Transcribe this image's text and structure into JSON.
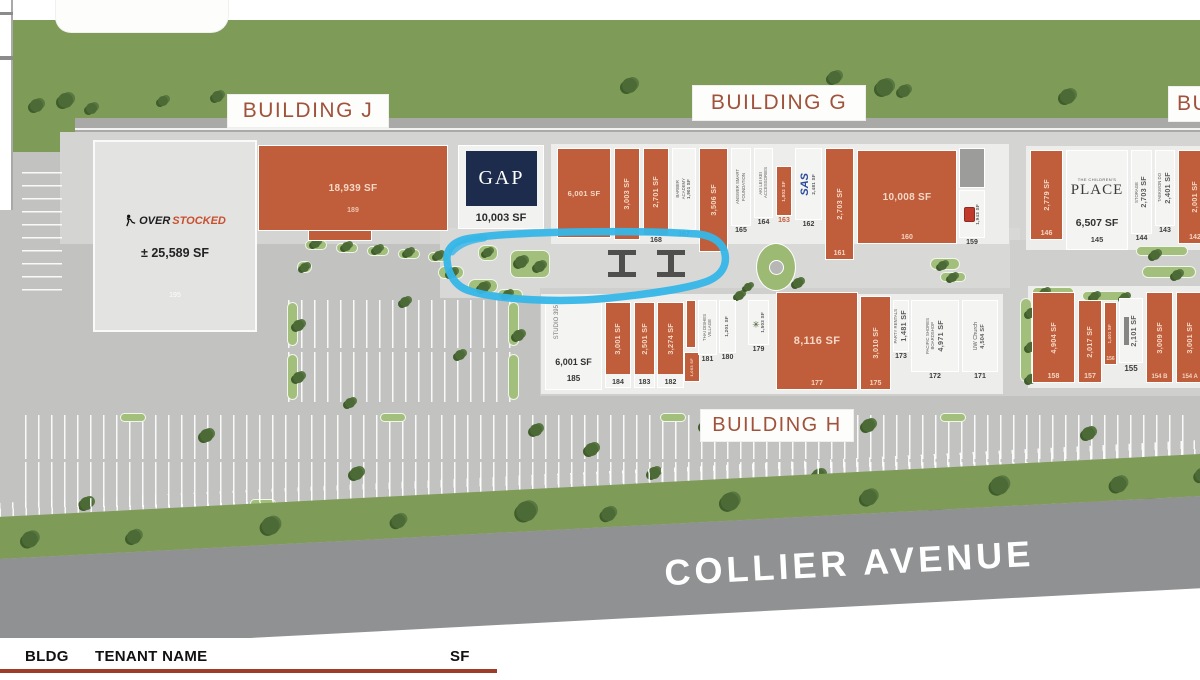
{
  "page": {
    "bg": "#ffffff"
  },
  "labels": {
    "building_j": "BUILDING J",
    "building_g": "BUILDING G",
    "building_f": "BUILDING F",
    "building_h": "BUILDING H"
  },
  "street": {
    "name": "COLLIER AVENUE"
  },
  "table_header": {
    "bldg": "BLDG",
    "tenant": "TENANT NAME",
    "sf": "SF"
  },
  "highlight": {
    "color": "#35b6e8"
  },
  "anchors": {
    "overstocked": {
      "prefix": "OVER",
      "suffix": "STOCKED",
      "sf": "± 25,589 SF",
      "num": "195"
    },
    "gap": {
      "logo": "GAP",
      "sf": "10,003 SF"
    },
    "childrens_place": {
      "top": "THE CHILDREN'S",
      "main": "PLACE"
    }
  },
  "units": [
    {
      "id": "189",
      "num": "189",
      "sf": "18,939 SF",
      "x": 258,
      "y": 145,
      "w": 190,
      "h": 86,
      "fill": "orange",
      "txt": "h",
      "numPos": "on",
      "sfFs": 10,
      "numBottom": 16,
      "numColor": "#eec4ad"
    },
    {
      "id": "170",
      "sf": "6,001 SF",
      "x": 557,
      "y": 148,
      "w": 54,
      "h": 90,
      "fill": "orange",
      "txt": "h",
      "sfFs": 7.5
    },
    {
      "id": "169",
      "sf": "3,003 SF",
      "x": 614,
      "y": 148,
      "w": 26,
      "h": 92,
      "fill": "orange",
      "txt": "v"
    },
    {
      "id": "168",
      "num": "168",
      "sf": "2,701 SF",
      "x": 643,
      "y": 148,
      "w": 26,
      "h": 88,
      "fill": "orange",
      "txt": "v",
      "numPos": "below"
    },
    {
      "id": "167",
      "num": "167",
      "name": "BARBER\nACADEMY",
      "sf": "1,901 SF",
      "x": 672,
      "y": 148,
      "w": 24,
      "h": 82,
      "fill": "white",
      "txt": "v",
      "numPos": "below",
      "sfFs": 4.3
    },
    {
      "id": "166",
      "sf": "3,506 SF",
      "x": 699,
      "y": 148,
      "w": 29,
      "h": 104,
      "fill": "orange",
      "txt": "v"
    },
    {
      "id": "165",
      "num": "165",
      "name": "ANSWER SMART\nFOUNDATION",
      "x": 731,
      "y": 148,
      "w": 20,
      "h": 78,
      "fill": "white",
      "txt": "v",
      "numPos": "below"
    },
    {
      "id": "164",
      "num": "164",
      "name": "AKI LEI KEI\nACCESSORIES",
      "x": 754,
      "y": 148,
      "w": 19,
      "h": 70,
      "fill": "white",
      "txt": "v",
      "numPos": "below"
    },
    {
      "id": "163",
      "num": "163",
      "sf": "1,802 SF",
      "x": 776,
      "y": 166,
      "w": 16,
      "h": 50,
      "fill": "orange",
      "txt": "v",
      "numPos": "below",
      "numColor": "#c05e3b",
      "sfFs": 4.5
    },
    {
      "id": "162",
      "num": "162",
      "name": "SAS",
      "sf": "2,481 SF",
      "x": 795,
      "y": 148,
      "w": 27,
      "h": 72,
      "fill": "white",
      "txt": "v",
      "logo": "sas",
      "numPos": "below",
      "sfFs": 4.5
    },
    {
      "id": "161",
      "num": "161",
      "sf": "2,703 SF",
      "x": 825,
      "y": 148,
      "w": 29,
      "h": 112,
      "fill": "orange",
      "txt": "v",
      "numPos": "on"
    },
    {
      "id": "160",
      "num": "160",
      "sf": "10,008 SF",
      "x": 857,
      "y": 150,
      "w": 100,
      "h": 94,
      "fill": "orange",
      "txt": "h",
      "numPos": "on",
      "sfFs": 10
    },
    {
      "id": "svc-g",
      "x": 959,
      "y": 148,
      "w": 26,
      "h": 40,
      "fill": "dark"
    },
    {
      "id": "159",
      "num": "159",
      "sf": "1,943 SF",
      "x": 959,
      "y": 190,
      "w": 26,
      "h": 48,
      "fill": "white",
      "txt": "v",
      "icon": "red",
      "numPos": "below",
      "sfFs": 4.5
    },
    {
      "id": "146",
      "num": "146",
      "sf": "2,779 SF",
      "x": 1030,
      "y": 150,
      "w": 33,
      "h": 90,
      "fill": "orange",
      "txt": "v",
      "numPos": "on"
    },
    {
      "id": "145",
      "num": "145",
      "sf": "6,507 SF",
      "x": 1066,
      "y": 150,
      "w": 62,
      "h": 100,
      "fill": "white",
      "logo": "childrens"
    },
    {
      "id": "144",
      "num": "144",
      "name": "STORAGE",
      "sf": "2,703 SF",
      "x": 1131,
      "y": 150,
      "w": 21,
      "h": 84,
      "fill": "white",
      "txt": "v",
      "numPos": "below"
    },
    {
      "id": "143",
      "num": "143",
      "name": "TAEKWON DO",
      "sf": "2,401 SF",
      "x": 1155,
      "y": 150,
      "w": 20,
      "h": 76,
      "fill": "white",
      "txt": "v",
      "numPos": "below"
    },
    {
      "id": "142",
      "num": "142",
      "sf": "2,001 SF",
      "x": 1178,
      "y": 150,
      "w": 34,
      "h": 94,
      "fill": "orange",
      "txt": "v",
      "numPos": "on"
    },
    {
      "id": "185",
      "num": "185",
      "name": "STUDIO 395",
      "sf": "6,001 SF",
      "x": 545,
      "y": 298,
      "w": 57,
      "h": 92,
      "fill": "white",
      "logo": "studio"
    },
    {
      "id": "184",
      "num": "184",
      "sf": "3,001 SF",
      "x": 605,
      "y": 302,
      "w": 26,
      "h": 86,
      "fill": "orange-strip",
      "txt": "v",
      "numPos": "strip"
    },
    {
      "id": "183",
      "num": "183",
      "sf": "2,501 SF",
      "x": 634,
      "y": 302,
      "w": 21,
      "h": 86,
      "fill": "orange-strip",
      "txt": "v",
      "numPos": "strip"
    },
    {
      "id": "182",
      "num": "182",
      "sf": "3,274 SF",
      "x": 657,
      "y": 302,
      "w": 27,
      "h": 86,
      "fill": "orange-strip",
      "txt": "v",
      "numPos": "strip"
    },
    {
      "id": "sliver-a",
      "x": 686,
      "y": 300,
      "w": 10,
      "h": 48,
      "fill": "orange"
    },
    {
      "id": "sliver-b",
      "sf": "1,003 SF",
      "x": 684,
      "y": 352,
      "w": 16,
      "h": 30,
      "fill": "orange",
      "txt": "v",
      "sfFs": 4
    },
    {
      "id": "181",
      "num": "181",
      "name": "THAI DISHES\nVILLAGE",
      "x": 698,
      "y": 300,
      "w": 19,
      "h": 55,
      "fill": "white",
      "txt": "v",
      "numPos": "below"
    },
    {
      "id": "180",
      "num": "180",
      "sf": "1,201 SF",
      "x": 719,
      "y": 300,
      "w": 17,
      "h": 53,
      "fill": "white",
      "txt": "v",
      "numPos": "below",
      "sfFs": 4.5
    },
    {
      "id": "179",
      "num": "179",
      "sf": "1,503 SF",
      "x": 748,
      "y": 300,
      "w": 21,
      "h": 45,
      "fill": "white",
      "txt": "v",
      "icon": "palm",
      "numPos": "below",
      "sfFs": 4.5
    },
    {
      "id": "177",
      "num": "177",
      "sf": "8,116 SF",
      "x": 776,
      "y": 292,
      "w": 82,
      "h": 98,
      "fill": "orange",
      "txt": "h",
      "numPos": "on",
      "sfFs": 11
    },
    {
      "id": "175",
      "num": "175",
      "sf": "3,010 SF",
      "x": 860,
      "y": 296,
      "w": 31,
      "h": 94,
      "fill": "orange",
      "txt": "v",
      "numPos": "on"
    },
    {
      "id": "173",
      "num": "173",
      "name": "PARTY RENTALS",
      "sf": "1,481 SF",
      "x": 893,
      "y": 300,
      "w": 16,
      "h": 52,
      "fill": "white",
      "txt": "v",
      "numPos": "below"
    },
    {
      "id": "172",
      "num": "172",
      "name": "PACIFIC SHORES\nBOARDSHOP",
      "sf": "4,971 SF",
      "x": 911,
      "y": 300,
      "w": 48,
      "h": 72,
      "fill": "white",
      "txt": "v",
      "numPos": "below"
    },
    {
      "id": "171",
      "num": "171",
      "name": "UW Church",
      "sf": "4,504 SF",
      "x": 962,
      "y": 300,
      "w": 36,
      "h": 72,
      "fill": "white",
      "txt": "v",
      "numPos": "below",
      "nameFs": 5.5,
      "sfFs": 5.5
    },
    {
      "id": "158",
      "num": "158",
      "sf": "4,904 SF",
      "x": 1032,
      "y": 292,
      "w": 43,
      "h": 91,
      "fill": "orange",
      "txt": "v",
      "numPos": "on"
    },
    {
      "id": "157",
      "num": "157",
      "sf": "2,017 SF",
      "x": 1078,
      "y": 300,
      "w": 24,
      "h": 83,
      "fill": "orange",
      "txt": "v",
      "numPos": "on"
    },
    {
      "id": "156",
      "num": "156",
      "sf": "1,401 SF",
      "x": 1104,
      "y": 302,
      "w": 13,
      "h": 63,
      "fill": "orange",
      "txt": "v",
      "numPos": "on",
      "sfFs": 4.2,
      "numFs": 5
    },
    {
      "id": "155",
      "num": "155",
      "sf": "2,101 SF",
      "x": 1119,
      "y": 298,
      "w": 24,
      "h": 65,
      "fill": "white",
      "txt": "v",
      "icon": "bar",
      "numPos": "below",
      "numFs": 8
    },
    {
      "id": "154B",
      "num": "154 B",
      "sf": "3,009 SF",
      "x": 1146,
      "y": 292,
      "w": 27,
      "h": 91,
      "fill": "orange",
      "txt": "v",
      "numPos": "on",
      "numFs": 6
    },
    {
      "id": "154A",
      "num": "154 A",
      "sf": "3,001 SF",
      "x": 1176,
      "y": 292,
      "w": 28,
      "h": 91,
      "fill": "orange",
      "txt": "v",
      "numPos": "on",
      "numFs": 6
    }
  ],
  "landscape": {
    "planters": [
      [
        305,
        240,
        22,
        10
      ],
      [
        336,
        243,
        22,
        10
      ],
      [
        367,
        246,
        22,
        10
      ],
      [
        398,
        249,
        22,
        10
      ],
      [
        428,
        252,
        22,
        10
      ],
      [
        297,
        261,
        15,
        12
      ],
      [
        438,
        266,
        26,
        13
      ],
      [
        468,
        279,
        30,
        14
      ],
      [
        497,
        289,
        26,
        12
      ],
      [
        510,
        250,
        40,
        28
      ],
      [
        478,
        245,
        20,
        16
      ],
      [
        930,
        258,
        30,
        12
      ],
      [
        940,
        272,
        26,
        10
      ],
      [
        1032,
        287,
        42,
        10
      ],
      [
        1082,
        291,
        46,
        10
      ],
      [
        1020,
        298,
        12,
        84
      ],
      [
        1136,
        246,
        52,
        10
      ],
      [
        1142,
        266,
        54,
        12
      ],
      [
        287,
        302,
        11,
        44
      ],
      [
        287,
        354,
        11,
        46
      ],
      [
        508,
        302,
        11,
        44
      ],
      [
        508,
        354,
        11,
        46
      ],
      [
        120,
        413,
        26,
        9
      ],
      [
        380,
        413,
        26,
        9
      ],
      [
        660,
        413,
        26,
        9
      ],
      [
        940,
        413,
        26,
        9
      ],
      [
        250,
        499,
        26,
        9
      ],
      [
        520,
        499,
        26,
        9
      ],
      [
        800,
        499,
        26,
        9
      ],
      [
        1080,
        499,
        26,
        9
      ]
    ],
    "trees": [
      [
        30,
        99,
        13
      ],
      [
        58,
        93,
        15
      ],
      [
        86,
        103,
        11
      ],
      [
        158,
        96,
        10
      ],
      [
        212,
        91,
        11
      ],
      [
        622,
        78,
        15
      ],
      [
        828,
        71,
        13
      ],
      [
        876,
        79,
        17
      ],
      [
        898,
        85,
        12
      ],
      [
        1060,
        89,
        15
      ],
      [
        311,
        239,
        9
      ],
      [
        342,
        242,
        9
      ],
      [
        373,
        245,
        9
      ],
      [
        404,
        248,
        9
      ],
      [
        434,
        251,
        9
      ],
      [
        300,
        263,
        9
      ],
      [
        447,
        268,
        10
      ],
      [
        478,
        282,
        11
      ],
      [
        503,
        290,
        9
      ],
      [
        515,
        256,
        12
      ],
      [
        534,
        261,
        11
      ],
      [
        483,
        248,
        9
      ],
      [
        735,
        291,
        9
      ],
      [
        744,
        283,
        8
      ],
      [
        938,
        261,
        9
      ],
      [
        948,
        273,
        9
      ],
      [
        1040,
        288,
        9
      ],
      [
        1090,
        292,
        9
      ],
      [
        1120,
        293,
        9
      ],
      [
        1026,
        308,
        10
      ],
      [
        1026,
        342,
        10
      ],
      [
        1026,
        374,
        10
      ],
      [
        1150,
        250,
        10
      ],
      [
        1172,
        270,
        10
      ],
      [
        293,
        320,
        11
      ],
      [
        293,
        372,
        11
      ],
      [
        513,
        330,
        11
      ],
      [
        400,
        297,
        10
      ],
      [
        455,
        350,
        10
      ],
      [
        345,
        398,
        10
      ],
      [
        80,
        497,
        13
      ],
      [
        200,
        429,
        13
      ],
      [
        350,
        467,
        13
      ],
      [
        480,
        501,
        13
      ],
      [
        530,
        424,
        12
      ],
      [
        585,
        443,
        13
      ],
      [
        648,
        467,
        12
      ],
      [
        700,
        419,
        13
      ],
      [
        760,
        499,
        14
      ],
      [
        812,
        469,
        13
      ],
      [
        862,
        419,
        13
      ],
      [
        930,
        499,
        14
      ],
      [
        1012,
        467,
        13
      ],
      [
        1082,
        427,
        13
      ],
      [
        1142,
        497,
        13
      ],
      [
        793,
        278,
        10
      ]
    ],
    "collier_trees": [
      [
        60,
        30,
        16
      ],
      [
        165,
        34,
        14
      ],
      [
        300,
        28,
        18
      ],
      [
        430,
        32,
        14
      ],
      [
        555,
        26,
        20
      ],
      [
        640,
        36,
        14
      ],
      [
        760,
        28,
        18
      ],
      [
        900,
        32,
        16
      ],
      [
        1030,
        26,
        18
      ],
      [
        1150,
        32,
        16
      ],
      [
        1235,
        28,
        14
      ]
    ]
  },
  "parking_bands": [
    {
      "x": 288,
      "y": 300,
      "w": 230,
      "h": 48,
      "dir": "v"
    },
    {
      "x": 288,
      "y": 352,
      "w": 230,
      "h": 50,
      "dir": "v"
    },
    {
      "x": 22,
      "y": 172,
      "w": 40,
      "h": 128,
      "dir": "h"
    },
    {
      "x": 25,
      "y": 415,
      "w": 1165,
      "h": 44,
      "dir": "v"
    },
    {
      "x": 25,
      "y": 462,
      "w": 1165,
      "h": 45,
      "dir": "v"
    }
  ],
  "plaza": {
    "picnic_tables": [
      [
        608,
        250
      ],
      [
        657,
        250
      ]
    ],
    "fountain": [
      756,
      243
    ]
  }
}
